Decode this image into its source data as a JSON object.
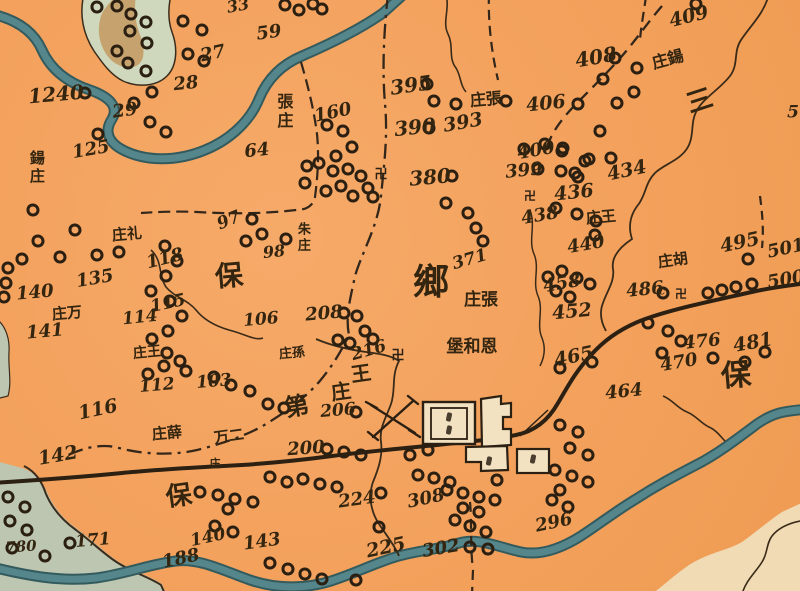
{
  "map": {
    "colors": {
      "paper": "#f3a15c",
      "ink": "#33250f",
      "river": "#55868b",
      "river_edge": "#335b5e",
      "island_green": "#cfd8bc",
      "island_tan": "#c49a60",
      "sw_region_green": "#bdc6b0",
      "se_region_cream": "#f0dbb4",
      "city_fill": "#f2e2c2"
    },
    "region_labels": [
      {
        "t": "鄉",
        "x": 431,
        "y": 283,
        "r": 0,
        "s": 36
      },
      {
        "t": "保",
        "x": 229,
        "y": 276,
        "r": -5,
        "s": 28
      },
      {
        "t": "保",
        "x": 179,
        "y": 497,
        "r": -8,
        "s": 26
      },
      {
        "t": "保",
        "x": 736,
        "y": 376,
        "r": -5,
        "s": 30
      },
      {
        "t": "三",
        "x": 700,
        "y": 102,
        "r": -18,
        "s": 26
      }
    ],
    "place_names": [
      {
        "t": "鍚庄",
        "x": 36,
        "y": 168,
        "r": 0,
        "s": 15,
        "v": true
      },
      {
        "t": "張庄",
        "x": 283,
        "y": 112,
        "r": 0,
        "s": 16,
        "v": true
      },
      {
        "t": "朱庄",
        "x": 302,
        "y": 238,
        "r": 0,
        "s": 13,
        "v": true
      },
      {
        "t": "庄張",
        "x": 486,
        "y": 100,
        "r": -5,
        "s": 16
      },
      {
        "t": "庄鍚",
        "x": 668,
        "y": 60,
        "r": -15,
        "s": 16
      },
      {
        "t": "庄礼",
        "x": 127,
        "y": 235,
        "r": -5,
        "s": 15
      },
      {
        "t": "庄万",
        "x": 67,
        "y": 314,
        "r": -5,
        "s": 15
      },
      {
        "t": "庄王",
        "x": 147,
        "y": 353,
        "r": -5,
        "s": 14
      },
      {
        "t": "庄孫",
        "x": 292,
        "y": 354,
        "r": -5,
        "s": 13
      },
      {
        "t": "庄張",
        "x": 481,
        "y": 301,
        "r": 0,
        "s": 17
      },
      {
        "t": "堡和恩",
        "x": 472,
        "y": 348,
        "r": 0,
        "s": 17
      },
      {
        "t": "王",
        "x": 361,
        "y": 374,
        "r": -8,
        "s": 20
      },
      {
        "t": "庄",
        "x": 341,
        "y": 392,
        "r": -8,
        "s": 20
      },
      {
        "t": "庄王",
        "x": 601,
        "y": 218,
        "r": -5,
        "s": 15
      },
      {
        "t": "庄胡",
        "x": 673,
        "y": 261,
        "r": -8,
        "s": 15
      },
      {
        "t": "万二",
        "x": 229,
        "y": 437,
        "r": -8,
        "s": 15
      },
      {
        "t": "庄",
        "x": 215,
        "y": 464,
        "r": 0,
        "s": 11
      },
      {
        "t": "庄薛",
        "x": 167,
        "y": 434,
        "r": -5,
        "s": 15
      },
      {
        "t": "第",
        "x": 297,
        "y": 406,
        "r": -10,
        "s": 24
      }
    ],
    "numbers": [
      {
        "t": "1240",
        "x": 56,
        "y": 94,
        "r": -5,
        "s": 20
      },
      {
        "t": "125",
        "x": 91,
        "y": 150,
        "r": -10,
        "s": 18
      },
      {
        "t": "27",
        "x": 213,
        "y": 54,
        "r": -12,
        "s": 18
      },
      {
        "t": "28",
        "x": 186,
        "y": 84,
        "r": -6,
        "s": 18
      },
      {
        "t": "29",
        "x": 125,
        "y": 111,
        "r": -8,
        "s": 18
      },
      {
        "t": "33",
        "x": 238,
        "y": 6,
        "r": -10,
        "s": 16
      },
      {
        "t": "59",
        "x": 269,
        "y": 33,
        "r": -8,
        "s": 18
      },
      {
        "t": "64",
        "x": 257,
        "y": 151,
        "r": -6,
        "s": 18
      },
      {
        "t": "160",
        "x": 333,
        "y": 113,
        "r": -12,
        "s": 18
      },
      {
        "t": "395",
        "x": 411,
        "y": 85,
        "r": -8,
        "s": 20
      },
      {
        "t": "390",
        "x": 415,
        "y": 127,
        "r": -6,
        "s": 20
      },
      {
        "t": "393",
        "x": 463,
        "y": 123,
        "r": -10,
        "s": 19
      },
      {
        "t": "380",
        "x": 430,
        "y": 177,
        "r": -5,
        "s": 20
      },
      {
        "t": "400",
        "x": 536,
        "y": 151,
        "r": -10,
        "s": 18
      },
      {
        "t": "399",
        "x": 524,
        "y": 171,
        "r": -6,
        "s": 18
      },
      {
        "t": "436",
        "x": 574,
        "y": 193,
        "r": -6,
        "s": 19
      },
      {
        "t": "438",
        "x": 540,
        "y": 216,
        "r": -10,
        "s": 18
      },
      {
        "t": "434",
        "x": 627,
        "y": 171,
        "r": -12,
        "s": 19
      },
      {
        "t": "406",
        "x": 546,
        "y": 104,
        "r": -6,
        "s": 19
      },
      {
        "t": "408",
        "x": 596,
        "y": 57,
        "r": -10,
        "s": 20
      },
      {
        "t": "409",
        "x": 689,
        "y": 17,
        "r": -14,
        "s": 19
      },
      {
        "t": "495",
        "x": 740,
        "y": 243,
        "r": -12,
        "s": 19
      },
      {
        "t": "501",
        "x": 786,
        "y": 249,
        "r": -12,
        "s": 18
      },
      {
        "t": "500",
        "x": 786,
        "y": 280,
        "r": -10,
        "s": 18
      },
      {
        "t": "486",
        "x": 645,
        "y": 290,
        "r": -6,
        "s": 18
      },
      {
        "t": "c",
        "x": 662,
        "y": 291,
        "r": 0,
        "s": 11
      },
      {
        "t": "458",
        "x": 562,
        "y": 284,
        "r": -10,
        "s": 18
      },
      {
        "t": "452",
        "x": 572,
        "y": 312,
        "r": -5,
        "s": 19
      },
      {
        "t": "440",
        "x": 586,
        "y": 245,
        "r": -10,
        "s": 18
      },
      {
        "t": "465",
        "x": 574,
        "y": 357,
        "r": -12,
        "s": 19
      },
      {
        "t": "476",
        "x": 702,
        "y": 342,
        "r": -6,
        "s": 18
      },
      {
        "t": "470",
        "x": 679,
        "y": 363,
        "r": -10,
        "s": 18
      },
      {
        "t": "481",
        "x": 753,
        "y": 343,
        "r": -10,
        "s": 19
      },
      {
        "t": "464",
        "x": 624,
        "y": 392,
        "r": -6,
        "s": 18
      },
      {
        "t": "97",
        "x": 229,
        "y": 221,
        "r": -22,
        "s": 17
      },
      {
        "t": "98",
        "x": 274,
        "y": 252,
        "r": -6,
        "s": 16
      },
      {
        "t": "371",
        "x": 470,
        "y": 260,
        "r": -16,
        "s": 17
      },
      {
        "t": "135",
        "x": 95,
        "y": 279,
        "r": -10,
        "s": 18
      },
      {
        "t": "140",
        "x": 35,
        "y": 293,
        "r": -5,
        "s": 18
      },
      {
        "t": "141",
        "x": 45,
        "y": 332,
        "r": -5,
        "s": 18
      },
      {
        "t": "118",
        "x": 165,
        "y": 259,
        "r": -14,
        "s": 18
      },
      {
        "t": "115",
        "x": 168,
        "y": 304,
        "r": -12,
        "s": 17
      },
      {
        "t": "114",
        "x": 140,
        "y": 318,
        "r": -6,
        "s": 17
      },
      {
        "t": "106",
        "x": 261,
        "y": 320,
        "r": -5,
        "s": 17
      },
      {
        "t": "208",
        "x": 324,
        "y": 314,
        "r": -5,
        "s": 18
      },
      {
        "t": "216",
        "x": 369,
        "y": 351,
        "r": -16,
        "s": 17
      },
      {
        "t": "112",
        "x": 157,
        "y": 386,
        "r": -5,
        "s": 17
      },
      {
        "t": "103",
        "x": 214,
        "y": 382,
        "r": -5,
        "s": 17
      },
      {
        "t": "116",
        "x": 98,
        "y": 410,
        "r": -12,
        "s": 19
      },
      {
        "t": "142",
        "x": 58,
        "y": 456,
        "r": -10,
        "s": 19
      },
      {
        "t": "206",
        "x": 338,
        "y": 411,
        "r": -5,
        "s": 17
      },
      {
        "t": "200",
        "x": 306,
        "y": 449,
        "r": -4,
        "s": 18
      },
      {
        "t": "224",
        "x": 357,
        "y": 500,
        "r": -8,
        "s": 18
      },
      {
        "t": "308",
        "x": 426,
        "y": 499,
        "r": -12,
        "s": 18
      },
      {
        "t": "225",
        "x": 386,
        "y": 548,
        "r": -12,
        "s": 19
      },
      {
        "t": "302",
        "x": 441,
        "y": 549,
        "r": -10,
        "s": 18
      },
      {
        "t": "296",
        "x": 554,
        "y": 523,
        "r": -12,
        "s": 18
      },
      {
        "t": "143",
        "x": 262,
        "y": 542,
        "r": -8,
        "s": 18
      },
      {
        "t": "171",
        "x": 93,
        "y": 541,
        "r": -5,
        "s": 17
      },
      {
        "t": "188",
        "x": 181,
        "y": 559,
        "r": -12,
        "s": 18
      },
      {
        "t": "140",
        "x": 208,
        "y": 538,
        "r": -12,
        "s": 17
      },
      {
        "t": "780",
        "x": 21,
        "y": 547,
        "r": -4,
        "s": 15
      },
      {
        "t": "5",
        "x": 793,
        "y": 113,
        "r": 0,
        "s": 17
      }
    ],
    "symbols": [
      {
        "t": "卍",
        "x": 381,
        "y": 175,
        "s": 13
      },
      {
        "t": "卍",
        "x": 530,
        "y": 196,
        "s": 12
      },
      {
        "t": "卍",
        "x": 398,
        "y": 356,
        "s": 13
      },
      {
        "t": "卍",
        "x": 681,
        "y": 294,
        "s": 12
      }
    ],
    "villages": [
      [
        97,
        7
      ],
      [
        117,
        6
      ],
      [
        131,
        14
      ],
      [
        146,
        22
      ],
      [
        130,
        31
      ],
      [
        147,
        43
      ],
      [
        117,
        51
      ],
      [
        128,
        63
      ],
      [
        146,
        71
      ],
      [
        183,
        21
      ],
      [
        202,
        30
      ],
      [
        188,
        54
      ],
      [
        204,
        61
      ],
      [
        152,
        92
      ],
      [
        134,
        103
      ],
      [
        85,
        93
      ],
      [
        98,
        134
      ],
      [
        150,
        122
      ],
      [
        166,
        132
      ],
      [
        285,
        5
      ],
      [
        299,
        10
      ],
      [
        313,
        4
      ],
      [
        322,
        9
      ],
      [
        33,
        210
      ],
      [
        22,
        259
      ],
      [
        8,
        268
      ],
      [
        38,
        241
      ],
      [
        60,
        257
      ],
      [
        97,
        255
      ],
      [
        119,
        252
      ],
      [
        75,
        230
      ],
      [
        327,
        125
      ],
      [
        343,
        131
      ],
      [
        352,
        147
      ],
      [
        336,
        156
      ],
      [
        319,
        163
      ],
      [
        333,
        171
      ],
      [
        348,
        169
      ],
      [
        361,
        176
      ],
      [
        341,
        186
      ],
      [
        326,
        191
      ],
      [
        353,
        196
      ],
      [
        307,
        166
      ],
      [
        305,
        183
      ],
      [
        368,
        188
      ],
      [
        373,
        197
      ],
      [
        427,
        84
      ],
      [
        434,
        101
      ],
      [
        456,
        104
      ],
      [
        429,
        128
      ],
      [
        452,
        176
      ],
      [
        446,
        203
      ],
      [
        468,
        213
      ],
      [
        476,
        228
      ],
      [
        483,
        241
      ],
      [
        252,
        219
      ],
      [
        262,
        234
      ],
      [
        246,
        241
      ],
      [
        286,
        239
      ],
      [
        545,
        144
      ],
      [
        562,
        151
      ],
      [
        589,
        159
      ],
      [
        538,
        169
      ],
      [
        561,
        171
      ],
      [
        578,
        177
      ],
      [
        556,
        208
      ],
      [
        577,
        214
      ],
      [
        596,
        221
      ],
      [
        524,
        149
      ],
      [
        506,
        101
      ],
      [
        615,
        58
      ],
      [
        637,
        68
      ],
      [
        603,
        79
      ],
      [
        634,
        92
      ],
      [
        617,
        103
      ],
      [
        578,
        104
      ],
      [
        600,
        131
      ],
      [
        585,
        161
      ],
      [
        611,
        158
      ],
      [
        563,
        148
      ],
      [
        575,
        173
      ],
      [
        696,
        4
      ],
      [
        595,
        235
      ],
      [
        548,
        277
      ],
      [
        562,
        271
      ],
      [
        577,
        278
      ],
      [
        590,
        284
      ],
      [
        556,
        291
      ],
      [
        570,
        297
      ],
      [
        663,
        293
      ],
      [
        708,
        293
      ],
      [
        722,
        290
      ],
      [
        736,
        287
      ],
      [
        752,
        284
      ],
      [
        748,
        259
      ],
      [
        648,
        323
      ],
      [
        668,
        331
      ],
      [
        681,
        341
      ],
      [
        662,
        353
      ],
      [
        713,
        358
      ],
      [
        745,
        362
      ],
      [
        765,
        352
      ],
      [
        560,
        368
      ],
      [
        592,
        362
      ],
      [
        165,
        246
      ],
      [
        177,
        261
      ],
      [
        166,
        276
      ],
      [
        151,
        291
      ],
      [
        170,
        301
      ],
      [
        182,
        316
      ],
      [
        168,
        331
      ],
      [
        152,
        339
      ],
      [
        167,
        353
      ],
      [
        180,
        361
      ],
      [
        164,
        366
      ],
      [
        148,
        374
      ],
      [
        186,
        371
      ],
      [
        214,
        377
      ],
      [
        231,
        385
      ],
      [
        250,
        391
      ],
      [
        344,
        313
      ],
      [
        357,
        316
      ],
      [
        365,
        331
      ],
      [
        373,
        339
      ],
      [
        350,
        343
      ],
      [
        338,
        340
      ],
      [
        356,
        412
      ],
      [
        268,
        404
      ],
      [
        284,
        408
      ],
      [
        327,
        449
      ],
      [
        344,
        452
      ],
      [
        361,
        455
      ],
      [
        410,
        455
      ],
      [
        428,
        450
      ],
      [
        270,
        477
      ],
      [
        287,
        482
      ],
      [
        303,
        479
      ],
      [
        320,
        484
      ],
      [
        337,
        487
      ],
      [
        200,
        492
      ],
      [
        218,
        495
      ],
      [
        235,
        499
      ],
      [
        253,
        502
      ],
      [
        228,
        509
      ],
      [
        8,
        497
      ],
      [
        25,
        507
      ],
      [
        10,
        521
      ],
      [
        27,
        530
      ],
      [
        12,
        548
      ],
      [
        45,
        556
      ],
      [
        70,
        543
      ],
      [
        215,
        526
      ],
      [
        233,
        532
      ],
      [
        381,
        493
      ],
      [
        418,
        475
      ],
      [
        434,
        478
      ],
      [
        450,
        482
      ],
      [
        447,
        490
      ],
      [
        463,
        493
      ],
      [
        479,
        497
      ],
      [
        495,
        500
      ],
      [
        463,
        508
      ],
      [
        479,
        512
      ],
      [
        497,
        480
      ],
      [
        455,
        520
      ],
      [
        470,
        526
      ],
      [
        486,
        532
      ],
      [
        470,
        547
      ],
      [
        488,
        549
      ],
      [
        560,
        425
      ],
      [
        578,
        432
      ],
      [
        570,
        448
      ],
      [
        588,
        455
      ],
      [
        555,
        470
      ],
      [
        572,
        476
      ],
      [
        588,
        482
      ],
      [
        560,
        490
      ],
      [
        552,
        500
      ],
      [
        568,
        507
      ],
      [
        379,
        527
      ],
      [
        270,
        563
      ],
      [
        288,
        569
      ],
      [
        305,
        574
      ],
      [
        322,
        579
      ],
      [
        356,
        580
      ],
      [
        6,
        283
      ],
      [
        4,
        297
      ]
    ]
  }
}
